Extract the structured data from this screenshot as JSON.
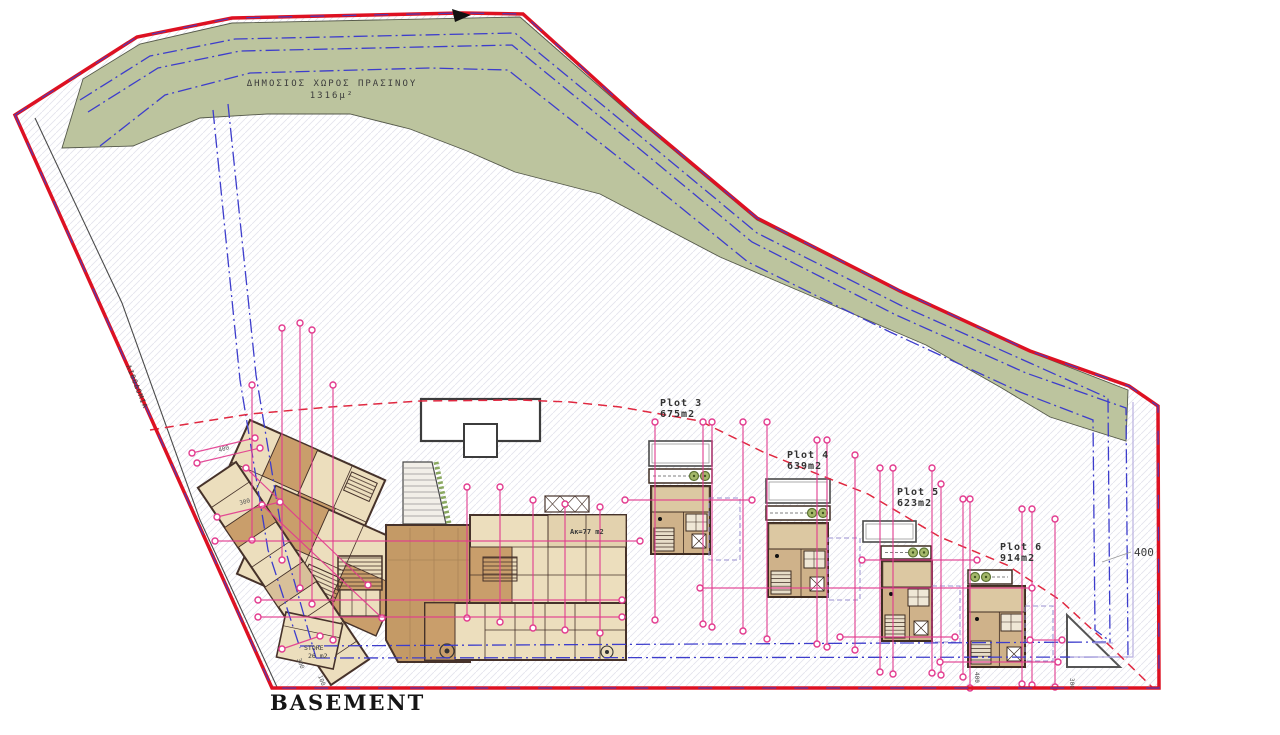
{
  "title": {
    "drawing": "BASEMENT"
  },
  "green_belt": {
    "line1": "ΔΗΜΟΣΙΟΣ ΧΩΡΟΣ ΠΡΑΣΙΝΟΥ",
    "line2": "1316μ²"
  },
  "road_label": "ΛΙΘΟΔΟΜΙΑ",
  "plots": [
    {
      "name": "Plot 3",
      "area": "675m2"
    },
    {
      "name": "Plot 4",
      "area": "639m2"
    },
    {
      "name": "Plot 5",
      "area": "623m2"
    },
    {
      "name": "Plot 6",
      "area": "914m2"
    }
  ],
  "rooms": {
    "store": "STORE",
    "store_area": "26 m2",
    "apartment_area": "Aκ=77 m2"
  },
  "dimensions": {
    "right_setback": "400",
    "d400": "400",
    "d300": "300",
    "d300b": "300",
    "d100": "100",
    "d300c": "300",
    "d400b": "400"
  },
  "colors": {
    "boundary_red": "#dd1122",
    "parcel_blue": "#3d3dcc",
    "dimension_pink": "#e23a8e",
    "green_belt": "#bcc49e",
    "building_tan": "#cfb28a",
    "building_cream": "#ecdebd",
    "garage_brown": "#c49a66",
    "wall_dark": "#46322a",
    "dashed_red": "#e02840"
  }
}
